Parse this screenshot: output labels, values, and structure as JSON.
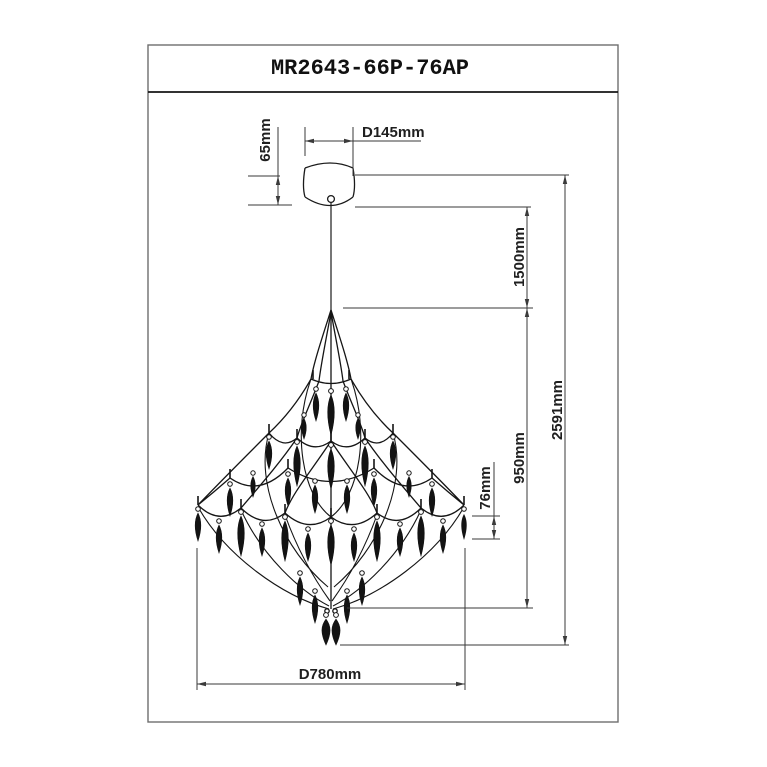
{
  "drawing": {
    "title": "MR2643-66P-76AP",
    "type_label": "chandelier-dimension-drawing",
    "line_color": "#1a1a1a",
    "dimensions": {
      "canopy_height": "65mm",
      "canopy_diameter": "D145mm",
      "suspension_length": "1500mm",
      "overall_height": "2591mm",
      "body_height": "950mm",
      "crystal_drop_height": "76mm",
      "body_diameter": "D780mm"
    }
  }
}
